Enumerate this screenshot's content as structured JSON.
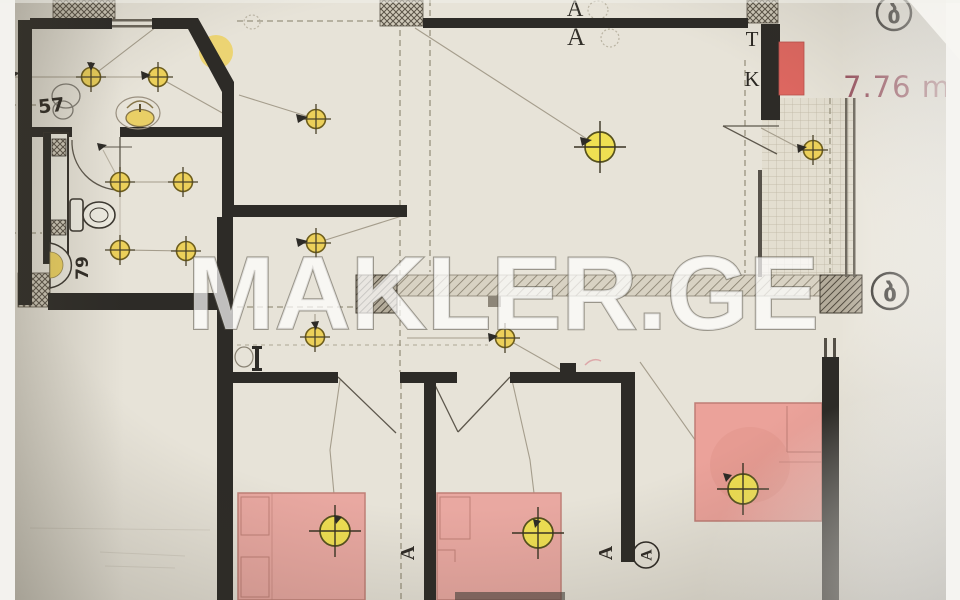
{
  "watermark": {
    "text": "MAKLER.GE"
  },
  "area_label": {
    "text": "7.76 m²"
  },
  "dimension_labels": {
    "width_57": "57",
    "height_79": "79"
  },
  "riser_labels": {
    "t": "T",
    "k": "K"
  },
  "axis_marker": "A",
  "room_letter": "ბ",
  "colors": {
    "paper": "#e7e3d8",
    "wall_black": "#2d2b27",
    "furniture_pink": "#e9a8a1",
    "armchair_pink": "#eba29a",
    "radiator_red": "#dd6760",
    "light_yellow": "#ecd05a",
    "light_yellow_bright": "#efdf52",
    "area_text": "#98525f",
    "watermark_fill": "rgba(255,255,255,0.70)",
    "watermark_outline": "rgba(90,85,75,0.55)"
  },
  "symbols": {
    "ceiling_light_small_count": 11,
    "ceiling_light_large_count": 4
  }
}
